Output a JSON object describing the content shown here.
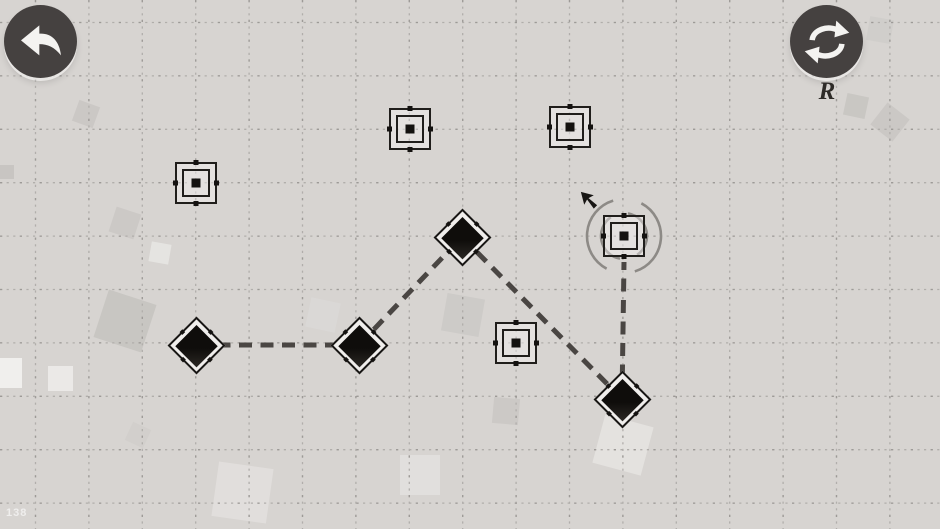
{
  "scene": {
    "watermark": "138",
    "background": "#d7d4d1",
    "grid_color": "#b1aeab",
    "grid_dark_color": "#9d9a97",
    "path_color": "#4a4643",
    "arc_color": "#8d8a86",
    "piece_color": "#131110",
    "grid_spacing": 53.4,
    "grid_offset_x": 35.5,
    "grid_offset_y": 22.5
  },
  "controls": {
    "undo_icon": "undo-arrow-icon",
    "restart_icon": "restart-cycle-icon",
    "restart_key_hint": "R"
  },
  "board": {
    "nodes": [
      {
        "x": 196,
        "y": 345
      },
      {
        "x": 359,
        "y": 345
      },
      {
        "x": 462,
        "y": 237
      },
      {
        "x": 622,
        "y": 399
      }
    ],
    "targets": [
      {
        "x": 196,
        "y": 183
      },
      {
        "x": 410,
        "y": 129
      },
      {
        "x": 570,
        "y": 127
      },
      {
        "x": 516,
        "y": 343
      },
      {
        "x": 624,
        "y": 236,
        "rotation_arcs": true
      }
    ],
    "links": [
      {
        "x1": 196,
        "y1": 345,
        "x2": 359,
        "y2": 345
      },
      {
        "x1": 359,
        "y1": 345,
        "x2": 462,
        "y2": 237
      },
      {
        "x1": 462,
        "y1": 237,
        "x2": 622,
        "y2": 399
      },
      {
        "x1": 622,
        "y1": 399,
        "x2": 624,
        "y2": 262
      }
    ],
    "rotation_arcs": [
      {
        "r": 23,
        "a1": 100,
        "a2": 235
      },
      {
        "r": 37,
        "a1": 118,
        "a2": 253
      },
      {
        "r": 23,
        "a1": 280,
        "a2": 415
      },
      {
        "r": 37,
        "a1": 298,
        "a2": 433
      }
    ],
    "cursor": {
      "x": 578,
      "y": 189
    }
  },
  "decor": {
    "squares": [
      {
        "x": 75,
        "y": 103,
        "s": 22,
        "r": 20,
        "c": "#c9c6c3",
        "o": 0.85
      },
      {
        "x": 112,
        "y": 210,
        "s": 26,
        "r": 18,
        "c": "#cac7c4",
        "o": 0.85
      },
      {
        "x": 150,
        "y": 243,
        "s": 20,
        "r": 10,
        "c": "#e9e7e5",
        "o": 0.8
      },
      {
        "x": 100,
        "y": 296,
        "s": 50,
        "r": 18,
        "c": "#c6c3c0",
        "o": 0.85
      },
      {
        "x": 48,
        "y": 366,
        "s": 25,
        "r": 0,
        "c": "#edebe9",
        "o": 0.9
      },
      {
        "x": 0,
        "y": 165,
        "s": 14,
        "r": 0,
        "c": "#c4c1be",
        "o": 0.8
      },
      {
        "x": -8,
        "y": 358,
        "s": 30,
        "r": 0,
        "c": "#f3f2f0",
        "o": 0.9
      },
      {
        "x": 444,
        "y": 296,
        "s": 38,
        "r": 10,
        "c": "#cbc8c5",
        "o": 0.8
      },
      {
        "x": 493,
        "y": 398,
        "s": 26,
        "r": 5,
        "c": "#c9c6c3",
        "o": 0.8
      },
      {
        "x": 845,
        "y": 95,
        "s": 22,
        "r": 12,
        "c": "#c7c4c1",
        "o": 0.85
      },
      {
        "x": 876,
        "y": 108,
        "s": 28,
        "r": 38,
        "c": "#c9c6c3",
        "o": 0.85
      },
      {
        "x": 598,
        "y": 420,
        "s": 50,
        "r": 15,
        "c": "#eae8e6",
        "o": 0.7
      },
      {
        "x": 215,
        "y": 465,
        "s": 55,
        "r": 8,
        "c": "#e7e5e3",
        "o": 0.6
      },
      {
        "x": 400,
        "y": 455,
        "s": 40,
        "r": 0,
        "c": "#e8e6e4",
        "o": 0.6
      },
      {
        "x": 308,
        "y": 300,
        "s": 30,
        "r": 12,
        "c": "#dcdad8",
        "o": 0.7
      },
      {
        "x": 128,
        "y": 425,
        "s": 20,
        "r": 25,
        "c": "#d0cdca",
        "o": 0.7
      },
      {
        "x": 868,
        "y": 18,
        "s": 24,
        "r": 10,
        "c": "#cccac7",
        "o": 0.6
      }
    ]
  }
}
